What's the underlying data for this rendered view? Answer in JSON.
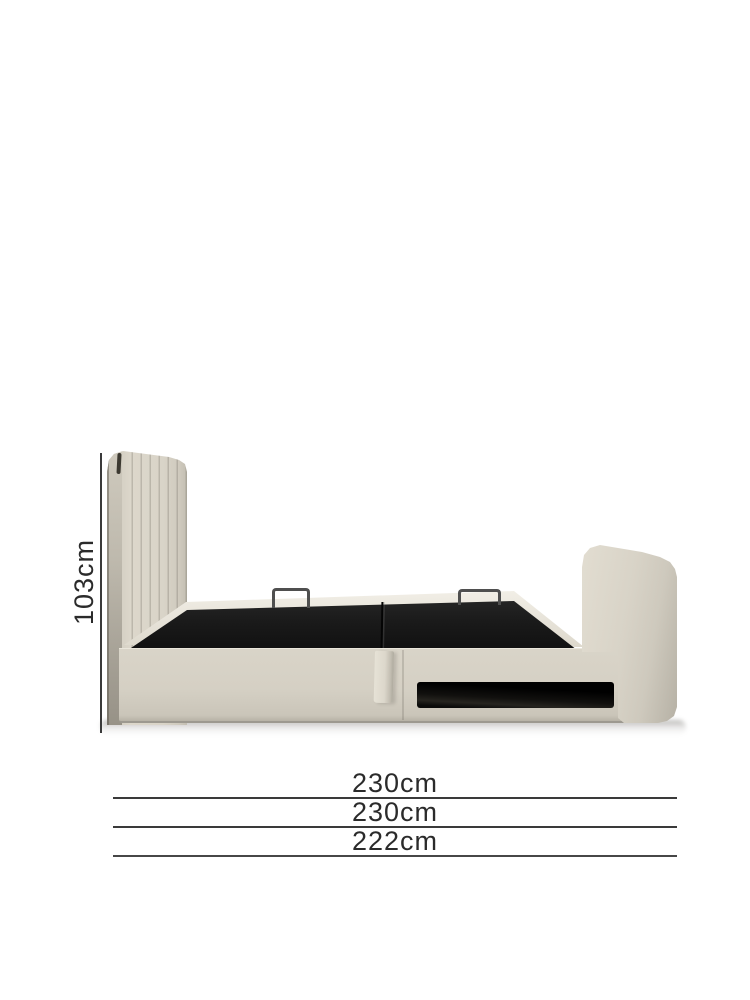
{
  "diagram": {
    "title": "Ottoman storage bed dimension diagram",
    "dimensions": {
      "height": {
        "label": "103cm",
        "axis": "vertical"
      },
      "widths": [
        {
          "label": "230cm"
        },
        {
          "label": "230cm"
        },
        {
          "label": "222cm"
        }
      ]
    },
    "colors": {
      "upholstery": "#dcd7cb",
      "upholstery_dark": "#b3aea2",
      "platform_black": "#1a1a1a",
      "handle_metal": "#4f4f4f",
      "dimension_line": "#3a3a3a",
      "label_text": "#2b2b2b",
      "background": "#ffffff"
    }
  }
}
